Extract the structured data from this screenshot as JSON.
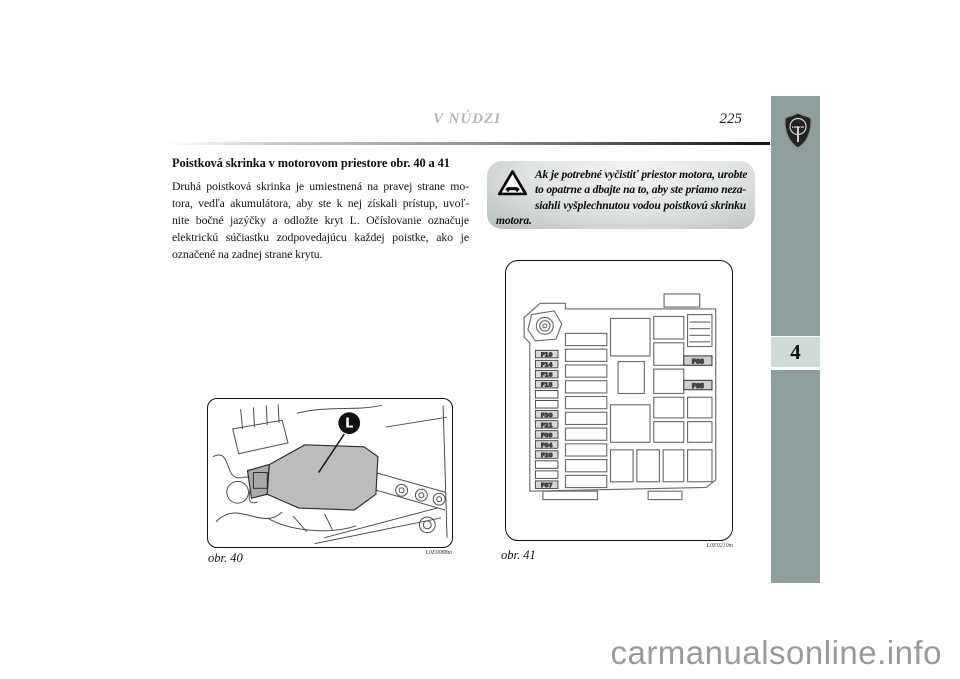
{
  "page": {
    "header_title": "V NÚDZI",
    "page_number": "225",
    "chapter_tab": "4",
    "watermark": "carmanualsonline.info"
  },
  "article": {
    "heading": "Poistková skrinka v motorovom priestore obr. 40 a 41",
    "body_lines": [
      "Druhá poistková skrinka je umiestnená na pravej strane mo-",
      "tora, vedľa akumulátora, aby ste k nej získali prístup, uvoľ-",
      "nite bočné jazýčky a odložte kryt L. Očíslovanie označuje",
      "elektrickú súčiastku zodpovedajúcu každej poistke, ako je",
      "označené na zadnej strane krytu."
    ]
  },
  "warning": {
    "lines": [
      "Ak je potrebné vyčistiť priestor motora, urobte",
      "to opatrne a dbajte na to, aby ste priamo neza-",
      "siahli vyšplechnutou vodou poistkovú skrinku",
      "motora."
    ]
  },
  "figures": {
    "fig40": {
      "caption": "obr. 40",
      "code": "L0E0088m",
      "callout": "L"
    },
    "fig41": {
      "caption": "obr. 41",
      "code": "L0E0210m",
      "left_fuses": [
        "F19",
        "F14",
        "F16",
        "F15",
        "",
        "",
        "F30",
        "F21",
        "F09",
        "F04",
        "F20",
        "",
        "",
        "F87"
      ],
      "right_fuses": [
        "F08",
        "F85"
      ]
    }
  },
  "icons": {
    "warning": "warning-triangle-icon",
    "brand": "lancia-logo"
  },
  "colors": {
    "sidebar_band": "#8d9e9c",
    "chapter_tab_bg": "#cfd9d7",
    "watermark": "#9a9a9a",
    "figure_cover_gray": "#bcbcbc"
  }
}
